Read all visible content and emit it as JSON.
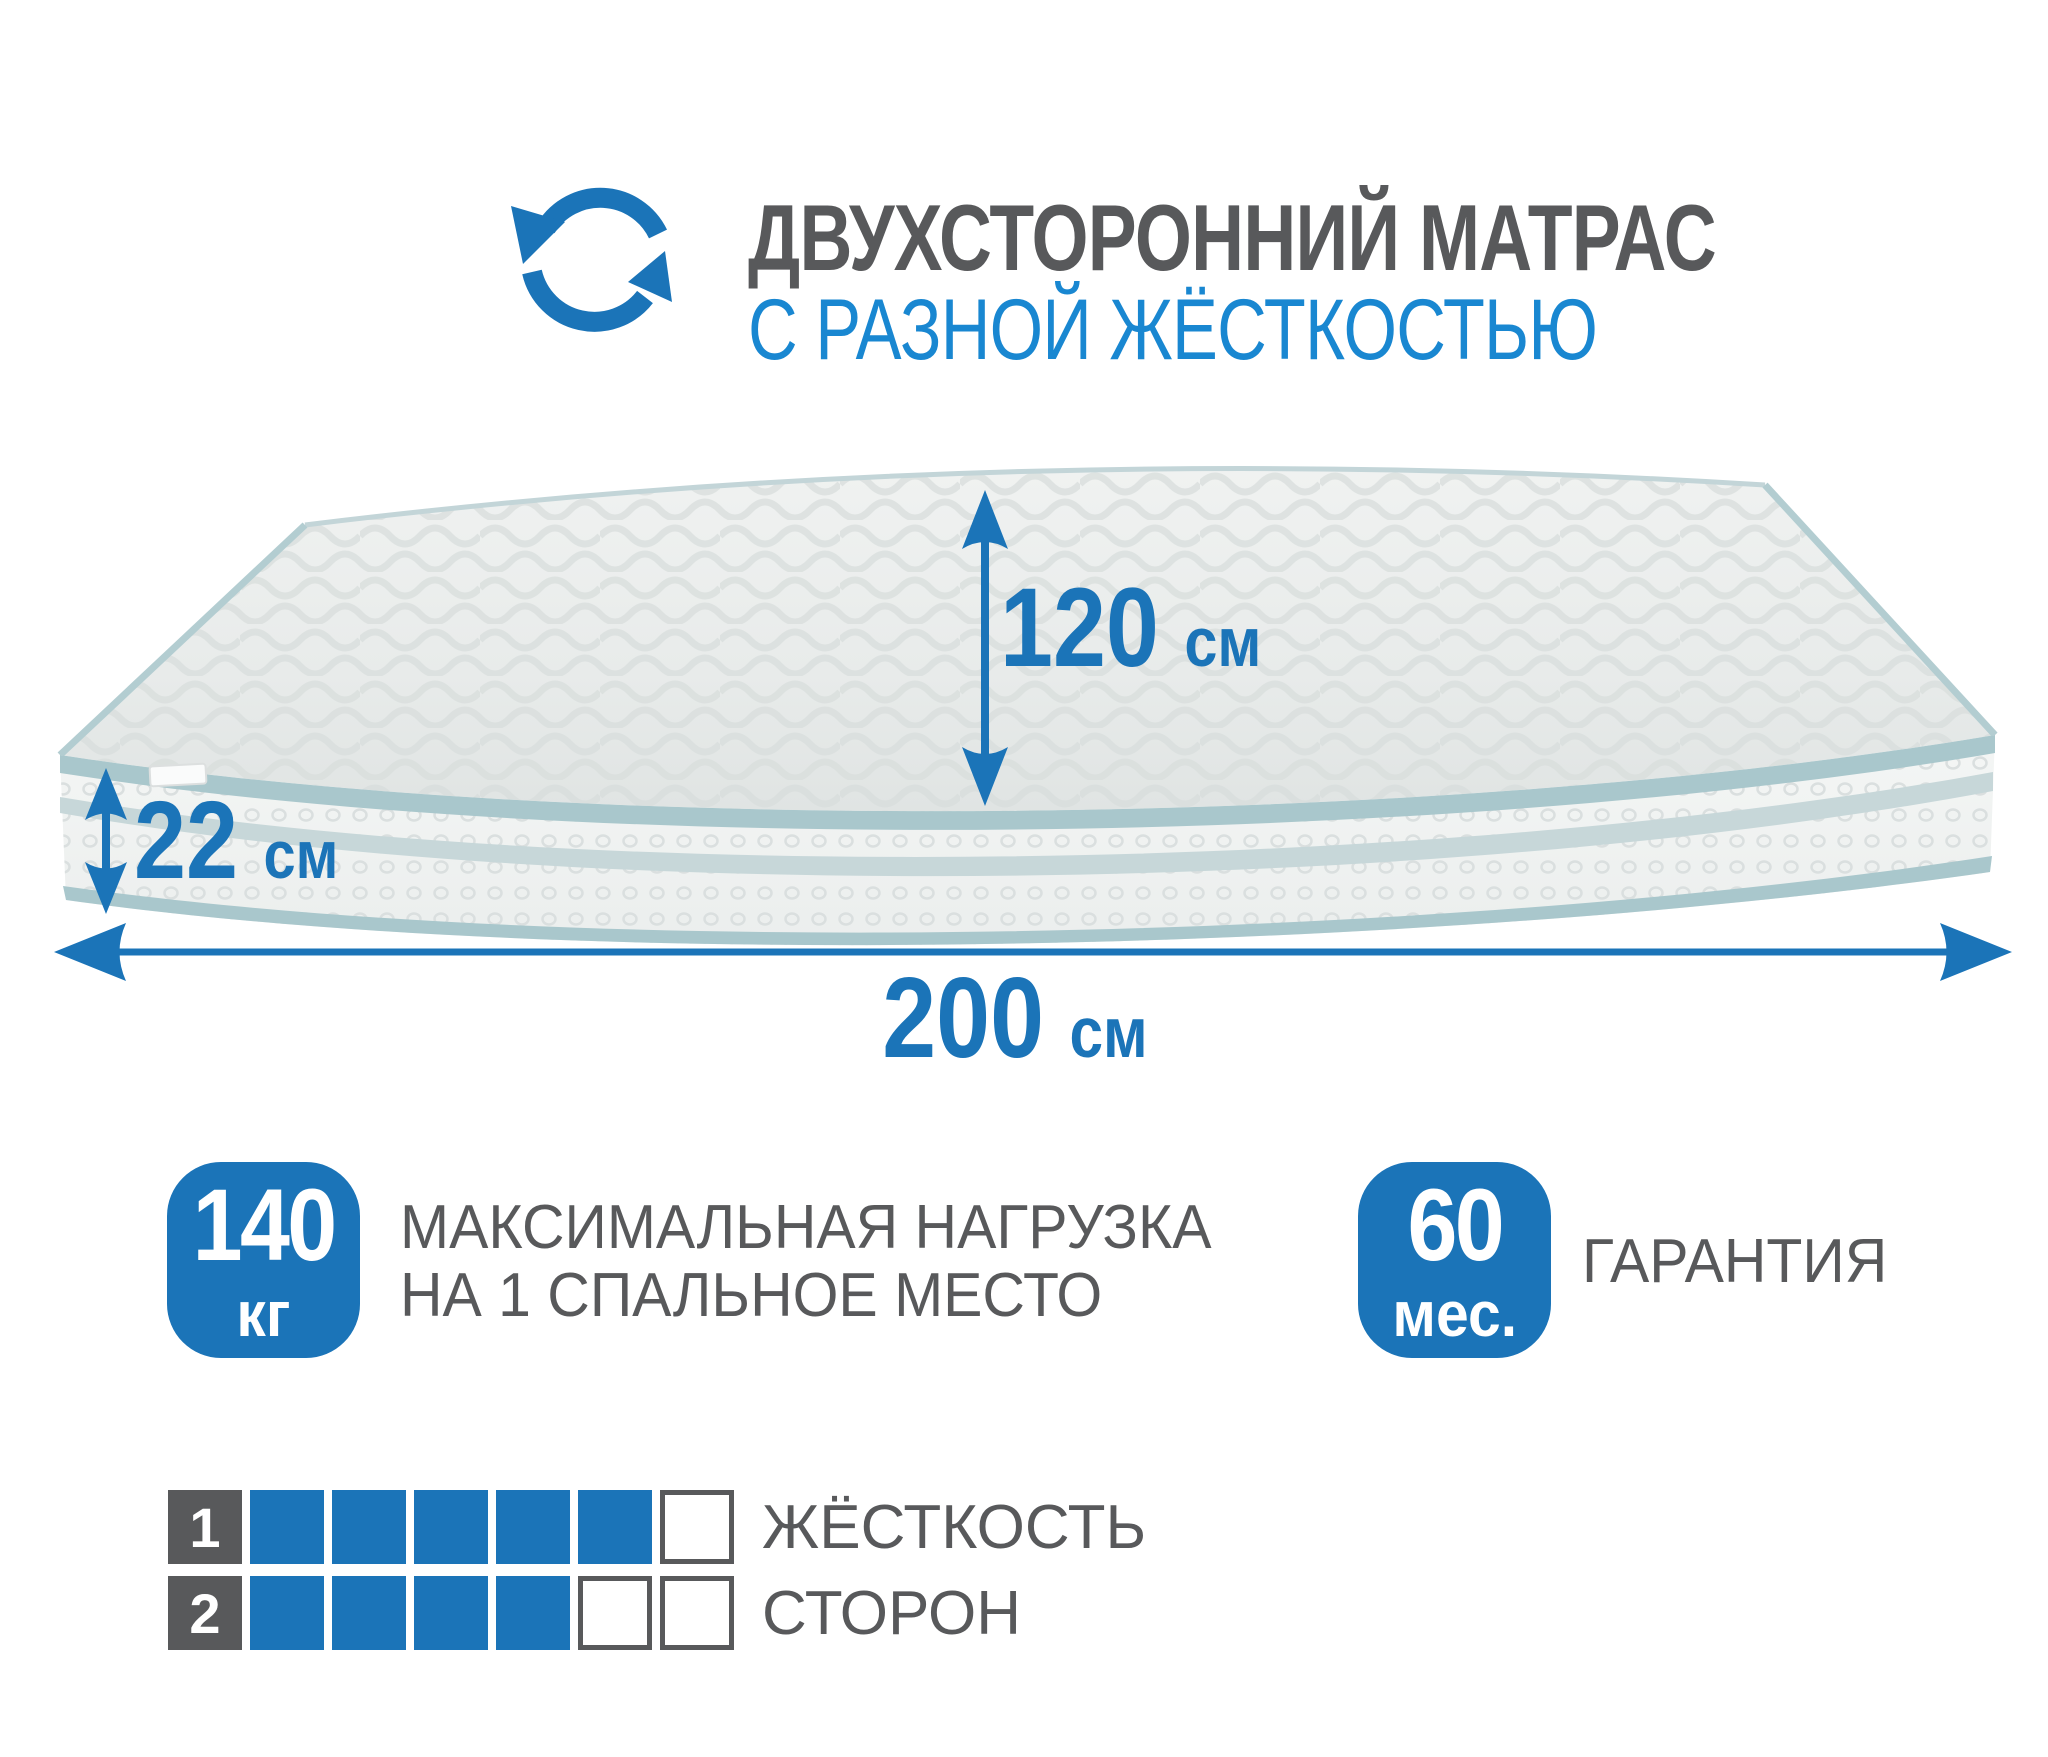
{
  "header": {
    "icon": "rotate-cycle-icon",
    "title": "ДВУХСТОРОННИЙ МАТРАС",
    "subtitle": "С РАЗНОЙ ЖЁСТКОСТЬЮ"
  },
  "dimensions": {
    "depth": {
      "value": "120",
      "unit": "см"
    },
    "height": {
      "value": "22",
      "unit": "см"
    },
    "width": {
      "value": "200",
      "unit": "см"
    }
  },
  "badges": {
    "max_load": {
      "value": "140",
      "unit": "кг",
      "label_line1": "МАКСИМАЛЬНАЯ НАГРУЗКА",
      "label_line2": "НА 1 СПАЛЬНОЕ МЕСТО"
    },
    "warranty": {
      "value": "60",
      "unit": "мес.",
      "label": "ГАРАНТИЯ"
    }
  },
  "firmness": {
    "label_line1": "ЖЁСТКОСТЬ",
    "label_line2": "СТОРОН",
    "scale_max": 6,
    "sides": [
      {
        "number": "1",
        "filled": 5
      },
      {
        "number": "2",
        "filled": 4
      }
    ]
  },
  "colors": {
    "accent_blue": "#1B74B8",
    "subtitle_blue": "#1987D1",
    "text_gray": "#58595B",
    "piping_teal": "#A9C7CC",
    "stripe_teal": "#C7D7D9",
    "mattress_top": "#E9ECEB",
    "mattress_side": "#F1F3F2"
  }
}
